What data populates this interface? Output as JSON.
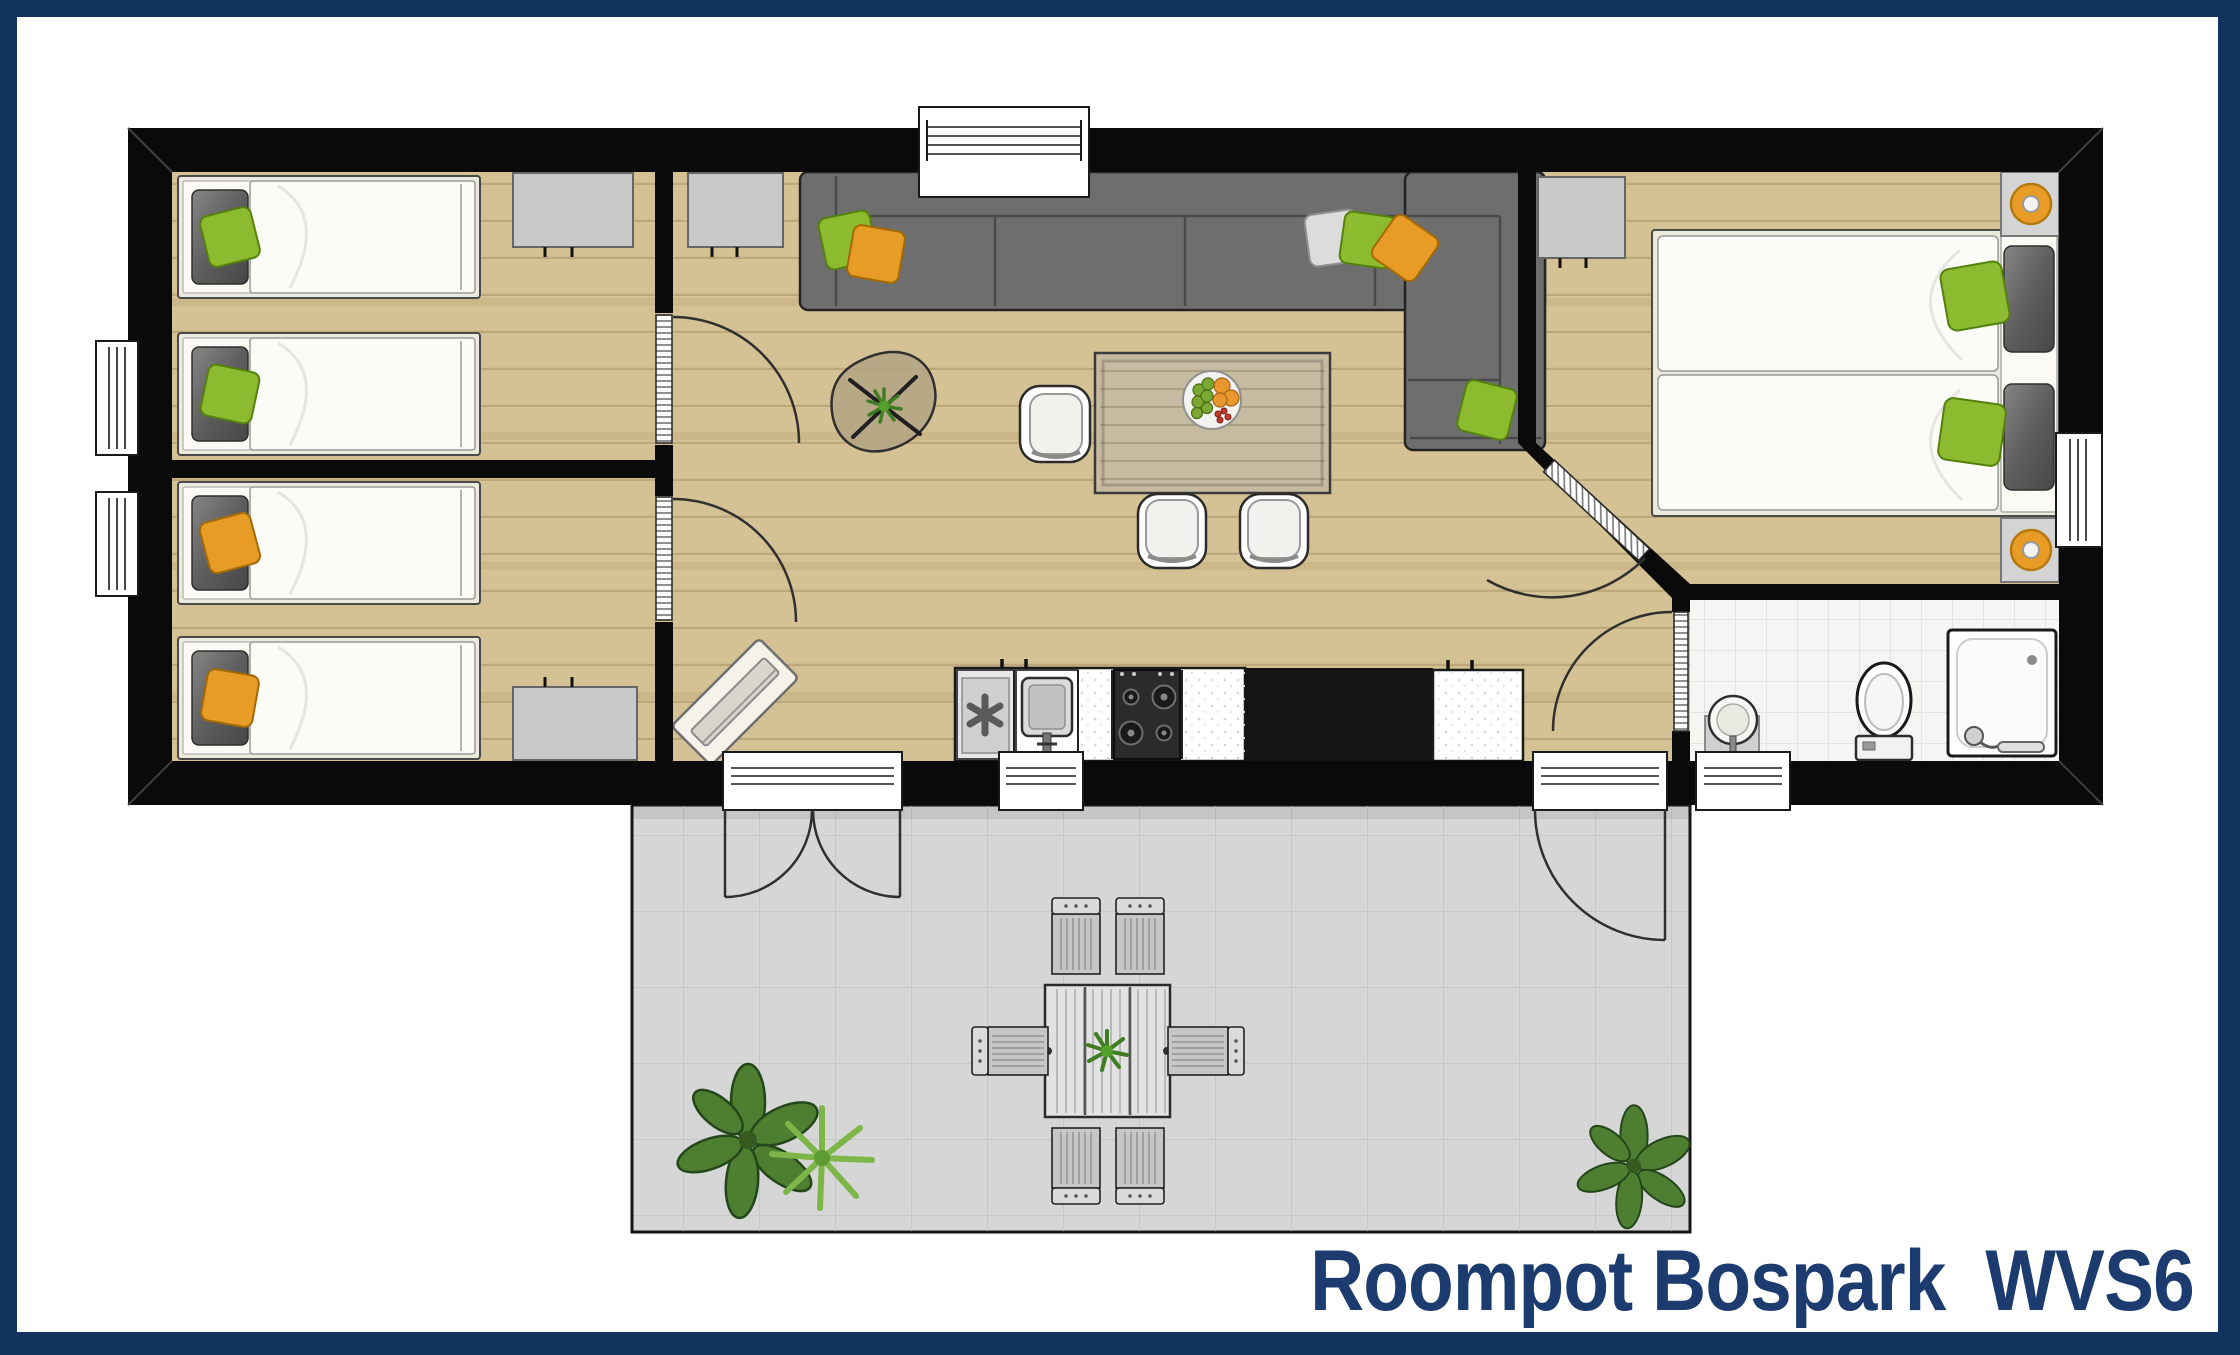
{
  "title": {
    "text": "Roompot Bospark  WVS6"
  },
  "colors": {
    "border": "#12335E",
    "paper": "#FFFFFF",
    "wall": "#0A0A0A",
    "wood": "#D5C294",
    "tile": "#F5F5F3",
    "terrace": "#D6D6D6",
    "sofa": "#6E6E6E",
    "cabinet": "#C9C9C9",
    "green": "#8CBB2F",
    "orange": "#E89B25",
    "bed_frame": "#ECEADF",
    "mattress": "#FBFBF8",
    "table_wood": "#C6BAA0",
    "title": "#1C3C70"
  }
}
